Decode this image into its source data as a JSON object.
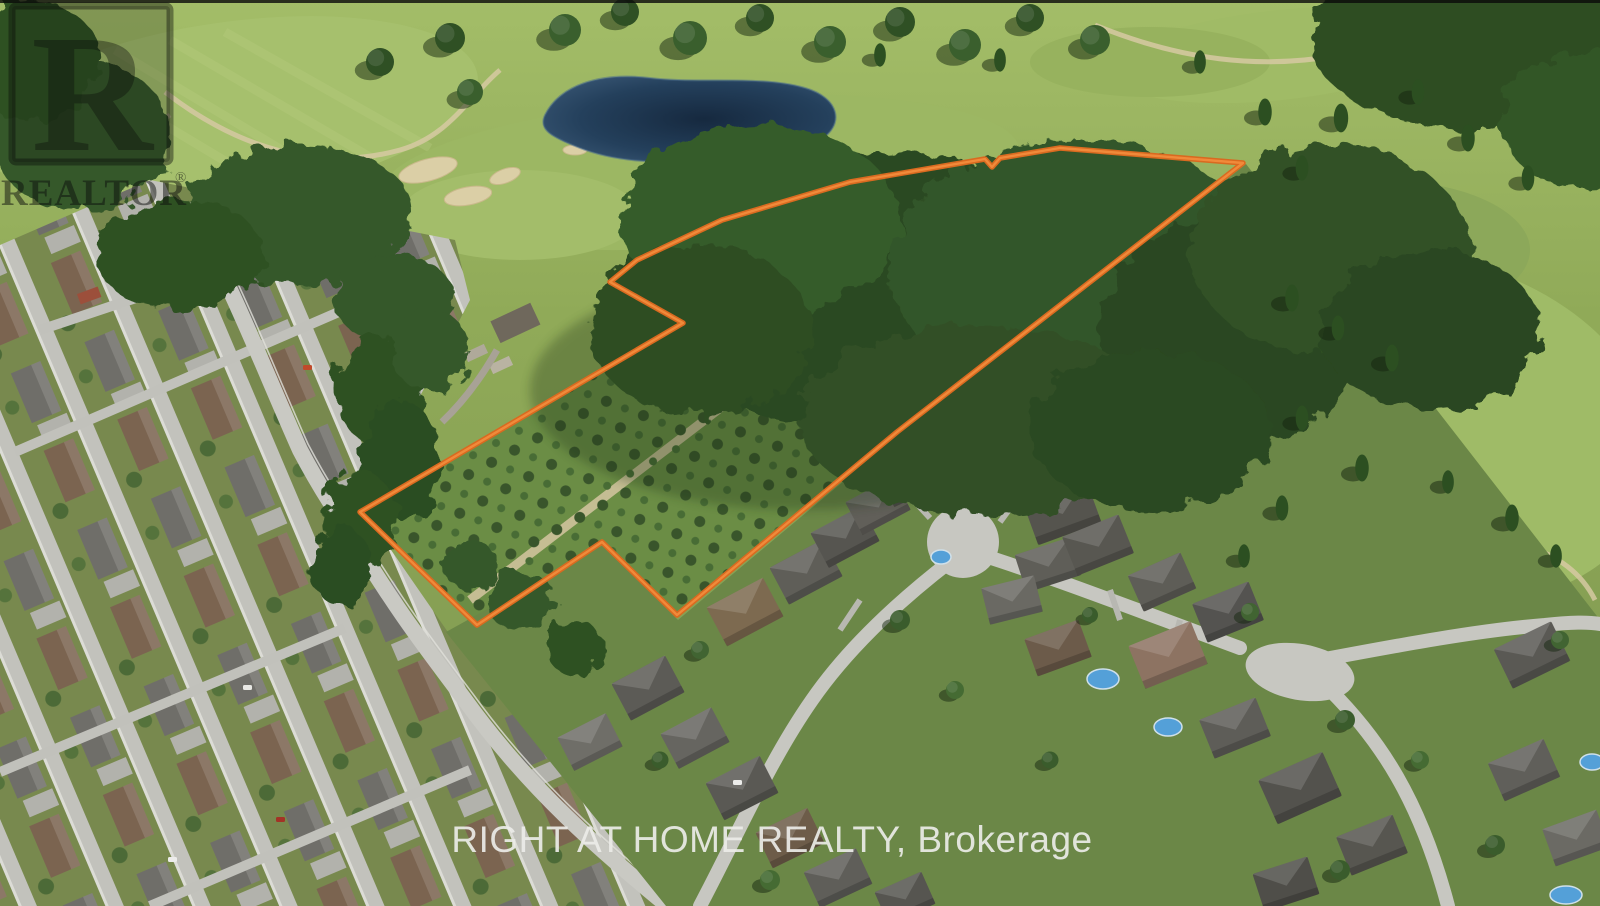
{
  "watermarks": {
    "realtor": {
      "letter": "R",
      "label": "REALTOR",
      "registered": "®"
    },
    "brokerage": {
      "text": "RIGHT AT HOME REALTY, Brokerage"
    }
  },
  "boundary": {
    "color": "#d96a20",
    "highlight": "#f08a3a",
    "points": [
      [
        1243,
        163
      ],
      [
        897,
        432
      ],
      [
        677,
        615
      ],
      [
        602,
        542
      ],
      [
        477,
        625
      ],
      [
        360,
        512
      ],
      [
        683,
        323
      ],
      [
        610,
        282
      ],
      [
        637,
        260
      ],
      [
        722,
        220
      ],
      [
        850,
        182
      ],
      [
        985,
        159
      ],
      [
        992,
        167
      ],
      [
        1000,
        158
      ],
      [
        1060,
        148
      ]
    ]
  }
}
